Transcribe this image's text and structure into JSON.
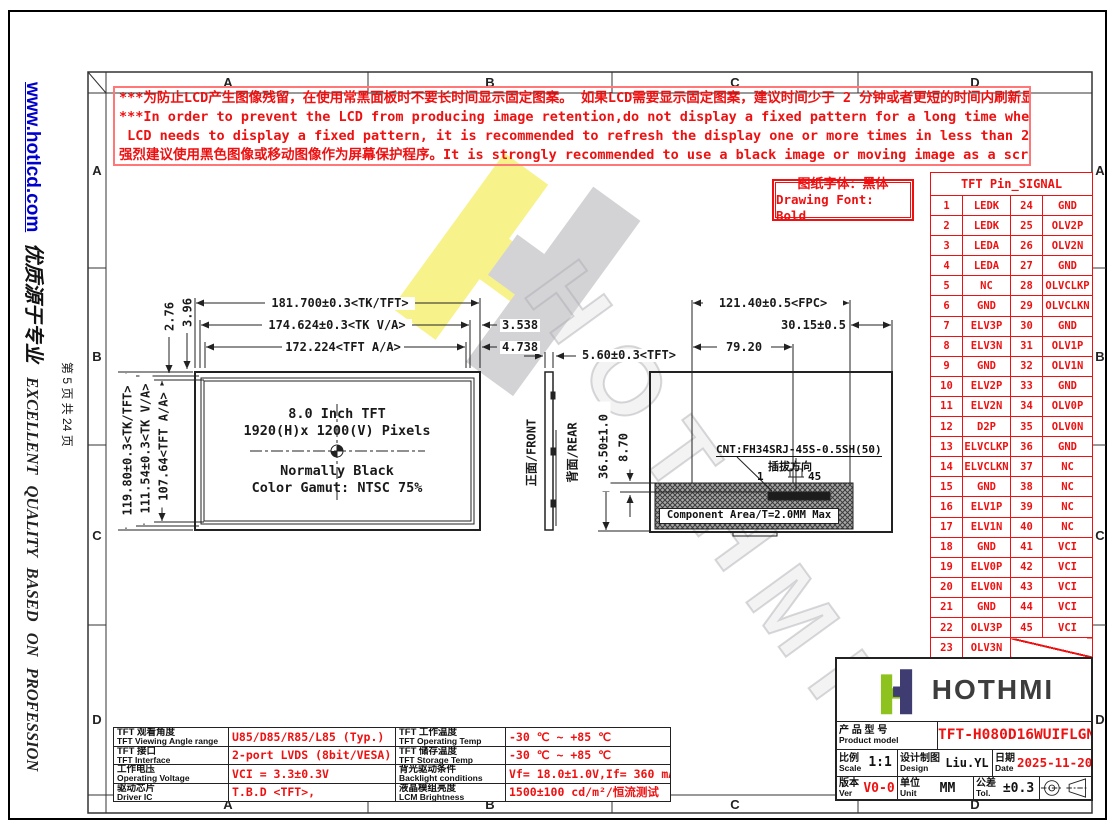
{
  "sidebar": {
    "url": "www.hotlcd.com",
    "slogan_cn": "优质源于专业",
    "page_info": "第 5 页 共 24 页",
    "slogan_en": "EXCELLENT QUALITY BASED ON PROFESSION"
  },
  "frame": {
    "col_labels": [
      "A",
      "B",
      "C",
      "D"
    ],
    "row_labels": [
      "A",
      "B",
      "C",
      "D"
    ]
  },
  "warning": {
    "line1": "***为防止LCD产生图像残留，在使用常黑面板时不要长时间显示固定图案。 如果LCD需要显示固定图案，建议时间少于 2 分钟或者更短的时间内刷新显示内容一次或多次。",
    "line2": "***In order to prevent the LCD from producing image retention,do not display a fixed pattern for a long time when using a normally black panel.If the",
    "line3": " LCD needs to display a fixed pattern, it is recommended to refresh the display one or more times in less than 2 minutes or less.",
    "line4": "强烈建议使用黑色图像或移动图像作为屏幕保护程序。It is strongly recommended to use a black image or moving image as a screen saver."
  },
  "font_note": {
    "cn": "图纸字体：黑体",
    "en": "Drawing Font: Bold"
  },
  "pin_table": {
    "title": "TFT Pin_SIGNAL",
    "rows": [
      [
        "1",
        "LEDK",
        "24",
        "GND"
      ],
      [
        "2",
        "LEDK",
        "25",
        "OLV2P"
      ],
      [
        "3",
        "LEDA",
        "26",
        "OLV2N"
      ],
      [
        "4",
        "LEDA",
        "27",
        "GND"
      ],
      [
        "5",
        "NC",
        "28",
        "OLVCLKP"
      ],
      [
        "6",
        "GND",
        "29",
        "OLVCLKN"
      ],
      [
        "7",
        "ELV3P",
        "30",
        "GND"
      ],
      [
        "8",
        "ELV3N",
        "31",
        "OLV1P"
      ],
      [
        "9",
        "GND",
        "32",
        "OLV1N"
      ],
      [
        "10",
        "ELV2P",
        "33",
        "GND"
      ],
      [
        "11",
        "ELV2N",
        "34",
        "OLV0P"
      ],
      [
        "12",
        "D2P",
        "35",
        "OLV0N"
      ],
      [
        "13",
        "ELVCLKP",
        "36",
        "GND"
      ],
      [
        "14",
        "ELVCLKN",
        "37",
        "NC"
      ],
      [
        "15",
        "GND",
        "38",
        "NC"
      ],
      [
        "16",
        "ELV1P",
        "39",
        "NC"
      ],
      [
        "17",
        "ELV1N",
        "40",
        "NC"
      ],
      [
        "18",
        "GND",
        "41",
        "VCI"
      ],
      [
        "19",
        "ELV0P",
        "42",
        "VCI"
      ],
      [
        "20",
        "ELV0N",
        "43",
        "VCI"
      ],
      [
        "21",
        "GND",
        "44",
        "VCI"
      ],
      [
        "22",
        "OLV3P",
        "45",
        "VCI"
      ],
      [
        "23",
        "OLV3N",
        "",
        ""
      ]
    ]
  },
  "front_view": {
    "dim_tk_w": "181.700±0.3<TK/TFT>",
    "dim_va_w": "174.624±0.3<TK V/A>",
    "dim_aa_w": "172.224<TFT A/A>",
    "dim_right1": "3.538",
    "dim_right2": "4.738",
    "dim_small1": "3.96",
    "dim_small2": "2.76",
    "dim_tk_h": "119.80±0.3<TK/TFT>",
    "dim_va_h": "111.54±0.3<TK V/A>",
    "dim_aa_h": "107.64<TFT A/A>",
    "line1": "8.0 Inch TFT",
    "line2": "1920(H)x 1200(V) Pixels",
    "line3": "Normally Black",
    "line4": "Color Gamut: NTSC 75%"
  },
  "side_view": {
    "dim_thickness": "5.60±0.3<TFT>",
    "front_label": "正面/FRONT",
    "rear_label": "背面/REAR"
  },
  "rear_view": {
    "dim_fpc_w": "121.40±0.5<FPC>",
    "dim_right": "30.15±0.5",
    "dim_left": "79.20",
    "dim_height": "36.50±1.0",
    "dim_conn": "8.70",
    "connector": "CNT:FH34SRJ-45S-0.5SH(50)",
    "direction": "插拔方向",
    "pin_start": "1",
    "pin_end": "45",
    "component_area": "Component Area/T=2.0MM Max"
  },
  "spec_table": {
    "rows": [
      {
        "l1cn": "TFT 观看角度",
        "l1en": "TFT Viewing Angle range",
        "v1": "U85/D85/R85/L85 (Typ.)",
        "l2cn": "TFT 工作温度",
        "l2en": "TFT Operating Temp",
        "v2": "-30 ℃ ~ +85 ℃"
      },
      {
        "l1cn": "TFT 接口",
        "l1en": "TFT Interface",
        "v1": "2-port LVDS (8bit/VESA)",
        "l2cn": "TFT 储存温度",
        "l2en": "TFT Storage Temp",
        "v2": "-30 ℃ ~ +85 ℃"
      },
      {
        "l1cn": "工作电压",
        "l1en": "Operating Voltage",
        "v1": "VCI = 3.3±0.3V",
        "l2cn": "背光驱动条件",
        "l2en": "Backlight conditions",
        "v2": "Vf= 18.0±1.0V,If= 360 mA"
      },
      {
        "l1cn": "驱动芯片",
        "l1en": "Driver IC",
        "v1": "T.B.D <TFT>,",
        "l2cn": "液晶模组亮度",
        "l2en": "LCM Brightness",
        "v2": "1500±100 cd/m²/恒流测试"
      }
    ]
  },
  "title_block": {
    "logo_text": "HOTHMI",
    "model_label_cn": "产 品 型 号",
    "model_label_en": "Product model",
    "model": "TFT-H080D16WUIFLGN40",
    "scale_label_cn": "比例",
    "scale_label_en": "Scale",
    "scale": "1:1",
    "design_label_cn": "设计制图",
    "design_label_en": "Design",
    "designer": "Liu.YL",
    "date_label_cn": "日期",
    "date_label_en": "Date",
    "date": "2025-11-20",
    "ver_label_cn": "版本",
    "ver_label_en": "Ver",
    "ver": "V0-0",
    "unit_label_cn": "单位",
    "unit_label_en": "Unit",
    "unit": "MM",
    "tol_label_cn": "公差",
    "tol_label_en": "Tol.",
    "tol": "±0.3"
  },
  "colors": {
    "accent_red": "#ee1111",
    "link_blue": "#0000cc",
    "logo_green": "#8dc21f",
    "logo_navy": "#3f3c71",
    "watermark_yellow": "#f6ef6e",
    "watermark_gray": "#c9c9cc"
  }
}
